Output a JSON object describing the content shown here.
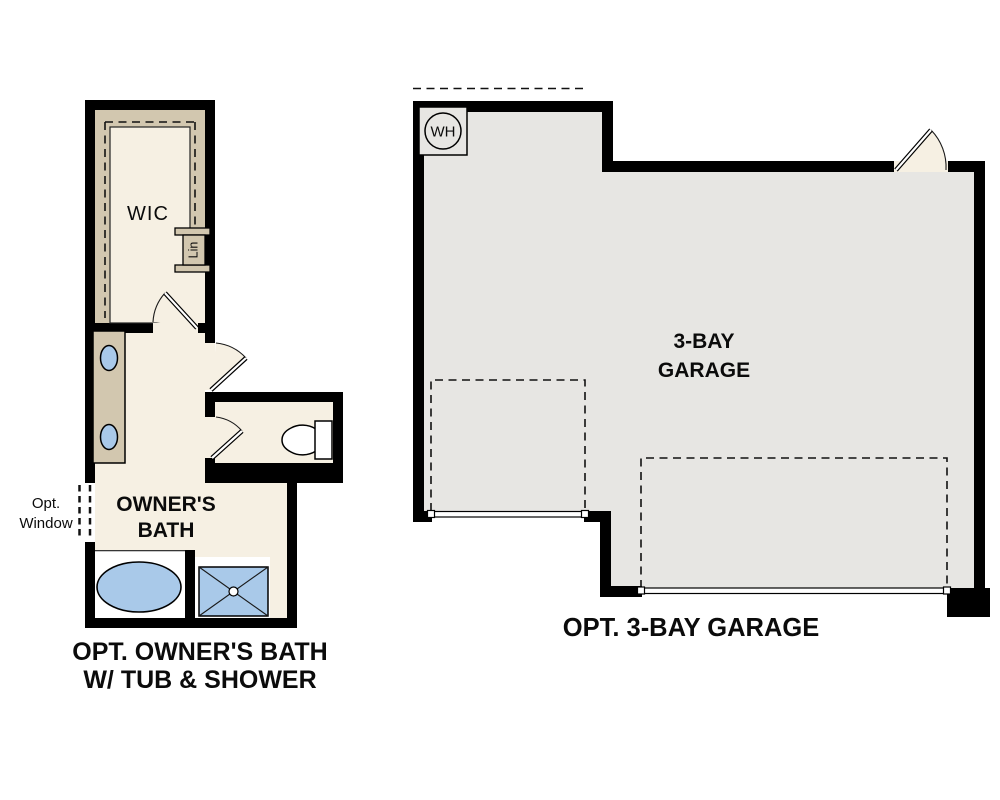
{
  "figure": {
    "type": "floor-plan-options",
    "bath_plan": {
      "wic_label": "WIC",
      "lin_label": "Lin",
      "opt_window_label": [
        "Opt.",
        "Window"
      ],
      "room_label": [
        "OWNER'S",
        "BATH"
      ],
      "caption": [
        "OPT. OWNER'S BATH",
        "W/ TUB & SHOWER"
      ],
      "fixtures": [
        "vanity-with-two-sinks",
        "toilet",
        "tub",
        "shower",
        "linen-closet",
        "walk-in-closet",
        "optional-window"
      ]
    },
    "garage_plan": {
      "water_heater_label": "WH",
      "room_label": [
        "3-BAY",
        "GARAGE"
      ],
      "caption": "OPT. 3-BAY GARAGE",
      "fixtures": [
        "water-heater",
        "single-garage-door",
        "double-garage-door",
        "entry-door"
      ]
    },
    "colors": {
      "wall_black": "#000000",
      "floor_cream": "#f6f0e3",
      "garage_floor_gray": "#e7e6e3",
      "cabinet_tan": "#d2c7af",
      "fixture_blue": "#a9c9e9",
      "fixture_white": "#ffffff",
      "text_black": "#0b0b0b"
    }
  }
}
